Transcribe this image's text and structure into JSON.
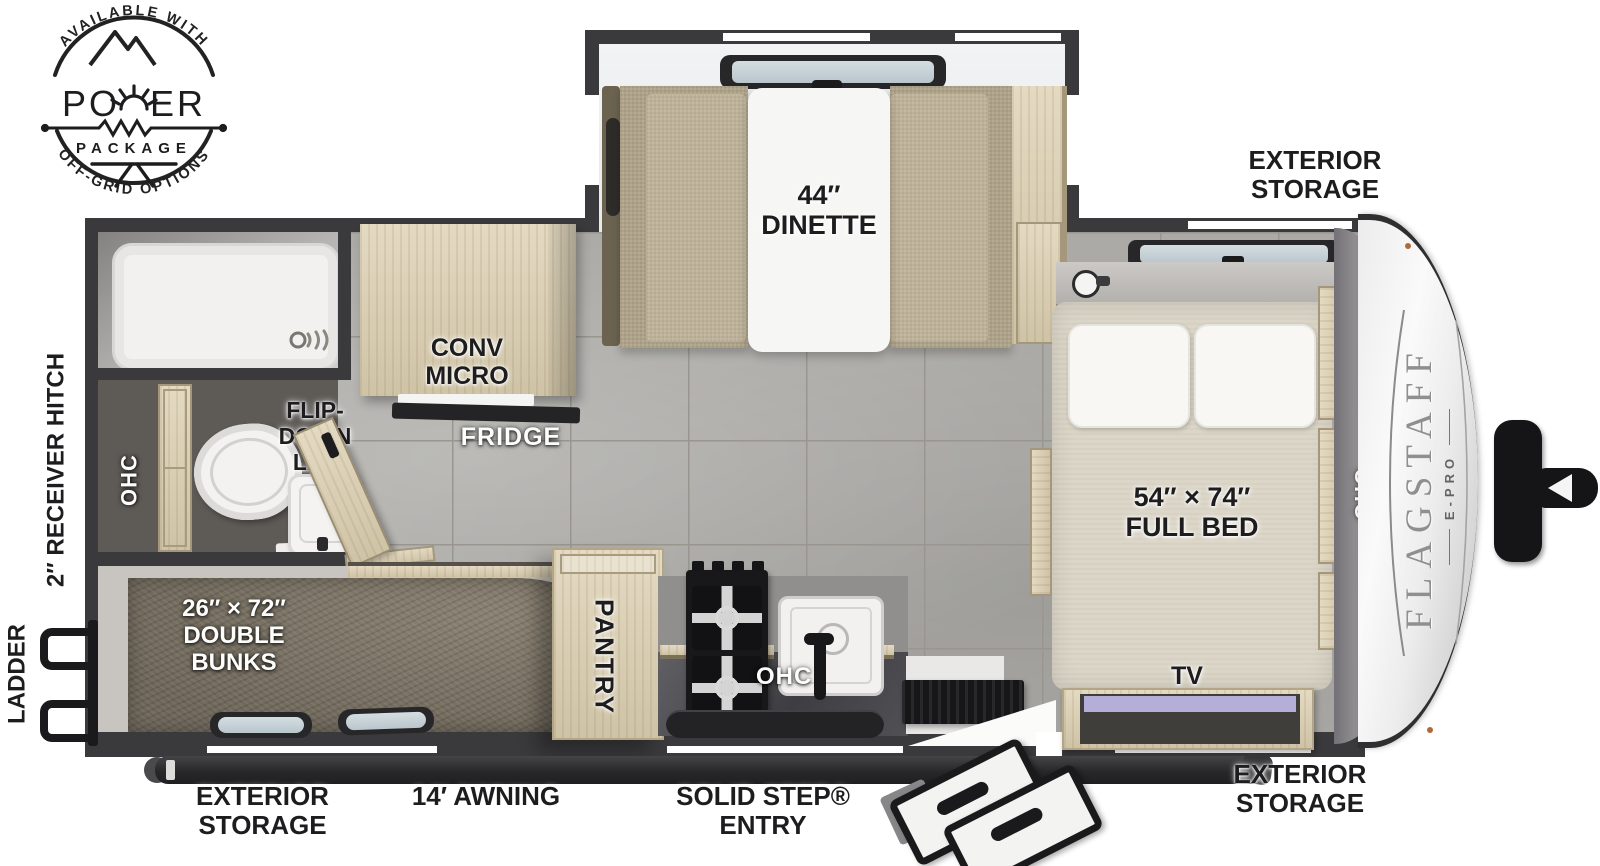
{
  "badge": {
    "arc_top": "AVAILABLE WITH",
    "power_left": "PO",
    "power_right": "ER",
    "package": "PACKAGE",
    "arc_bottom": "OFF-GRID OPTIONS"
  },
  "brand": {
    "name": "FLAGSTAFF",
    "sub": "E-PRO"
  },
  "callouts": {
    "storage_top_right": "EXTERIOR\nSTORAGE",
    "storage_bottom_left": "EXTERIOR\nSTORAGE",
    "storage_bottom_right": "EXTERIOR\nSTORAGE",
    "awning": "14′ AWNING",
    "entry": "SOLID STEP®\nENTRY",
    "hitch": "2″ RECEIVER HITCH",
    "ladder": "LADDER"
  },
  "interior": {
    "dinette": "44″\nDINETTE",
    "conv_micro": "CONV\nMICRO",
    "fridge": "FRIDGE",
    "flip_down_lav": "FLIP-\nDOWN\nLAV",
    "ohc_bath": "OHC",
    "ohc_kitchen": "OHC",
    "ohc_bed": "OHC",
    "pantry": "PANTRY",
    "full_bed": "54″ × 74″\nFULL BED",
    "double_bunks": "26″ × 72″\nDOUBLE\nBUNKS",
    "tv": "TV"
  },
  "colors": {
    "wall": "#3a3a3c",
    "floor_tile": "#abaaa6",
    "cabinet_wood": "#d9cdb2",
    "bunk_carpet": "#7b7467",
    "window_glass": "#c5d3da",
    "tv_screen": "#b5aed8",
    "brand_gray": "#8f8f8f"
  }
}
